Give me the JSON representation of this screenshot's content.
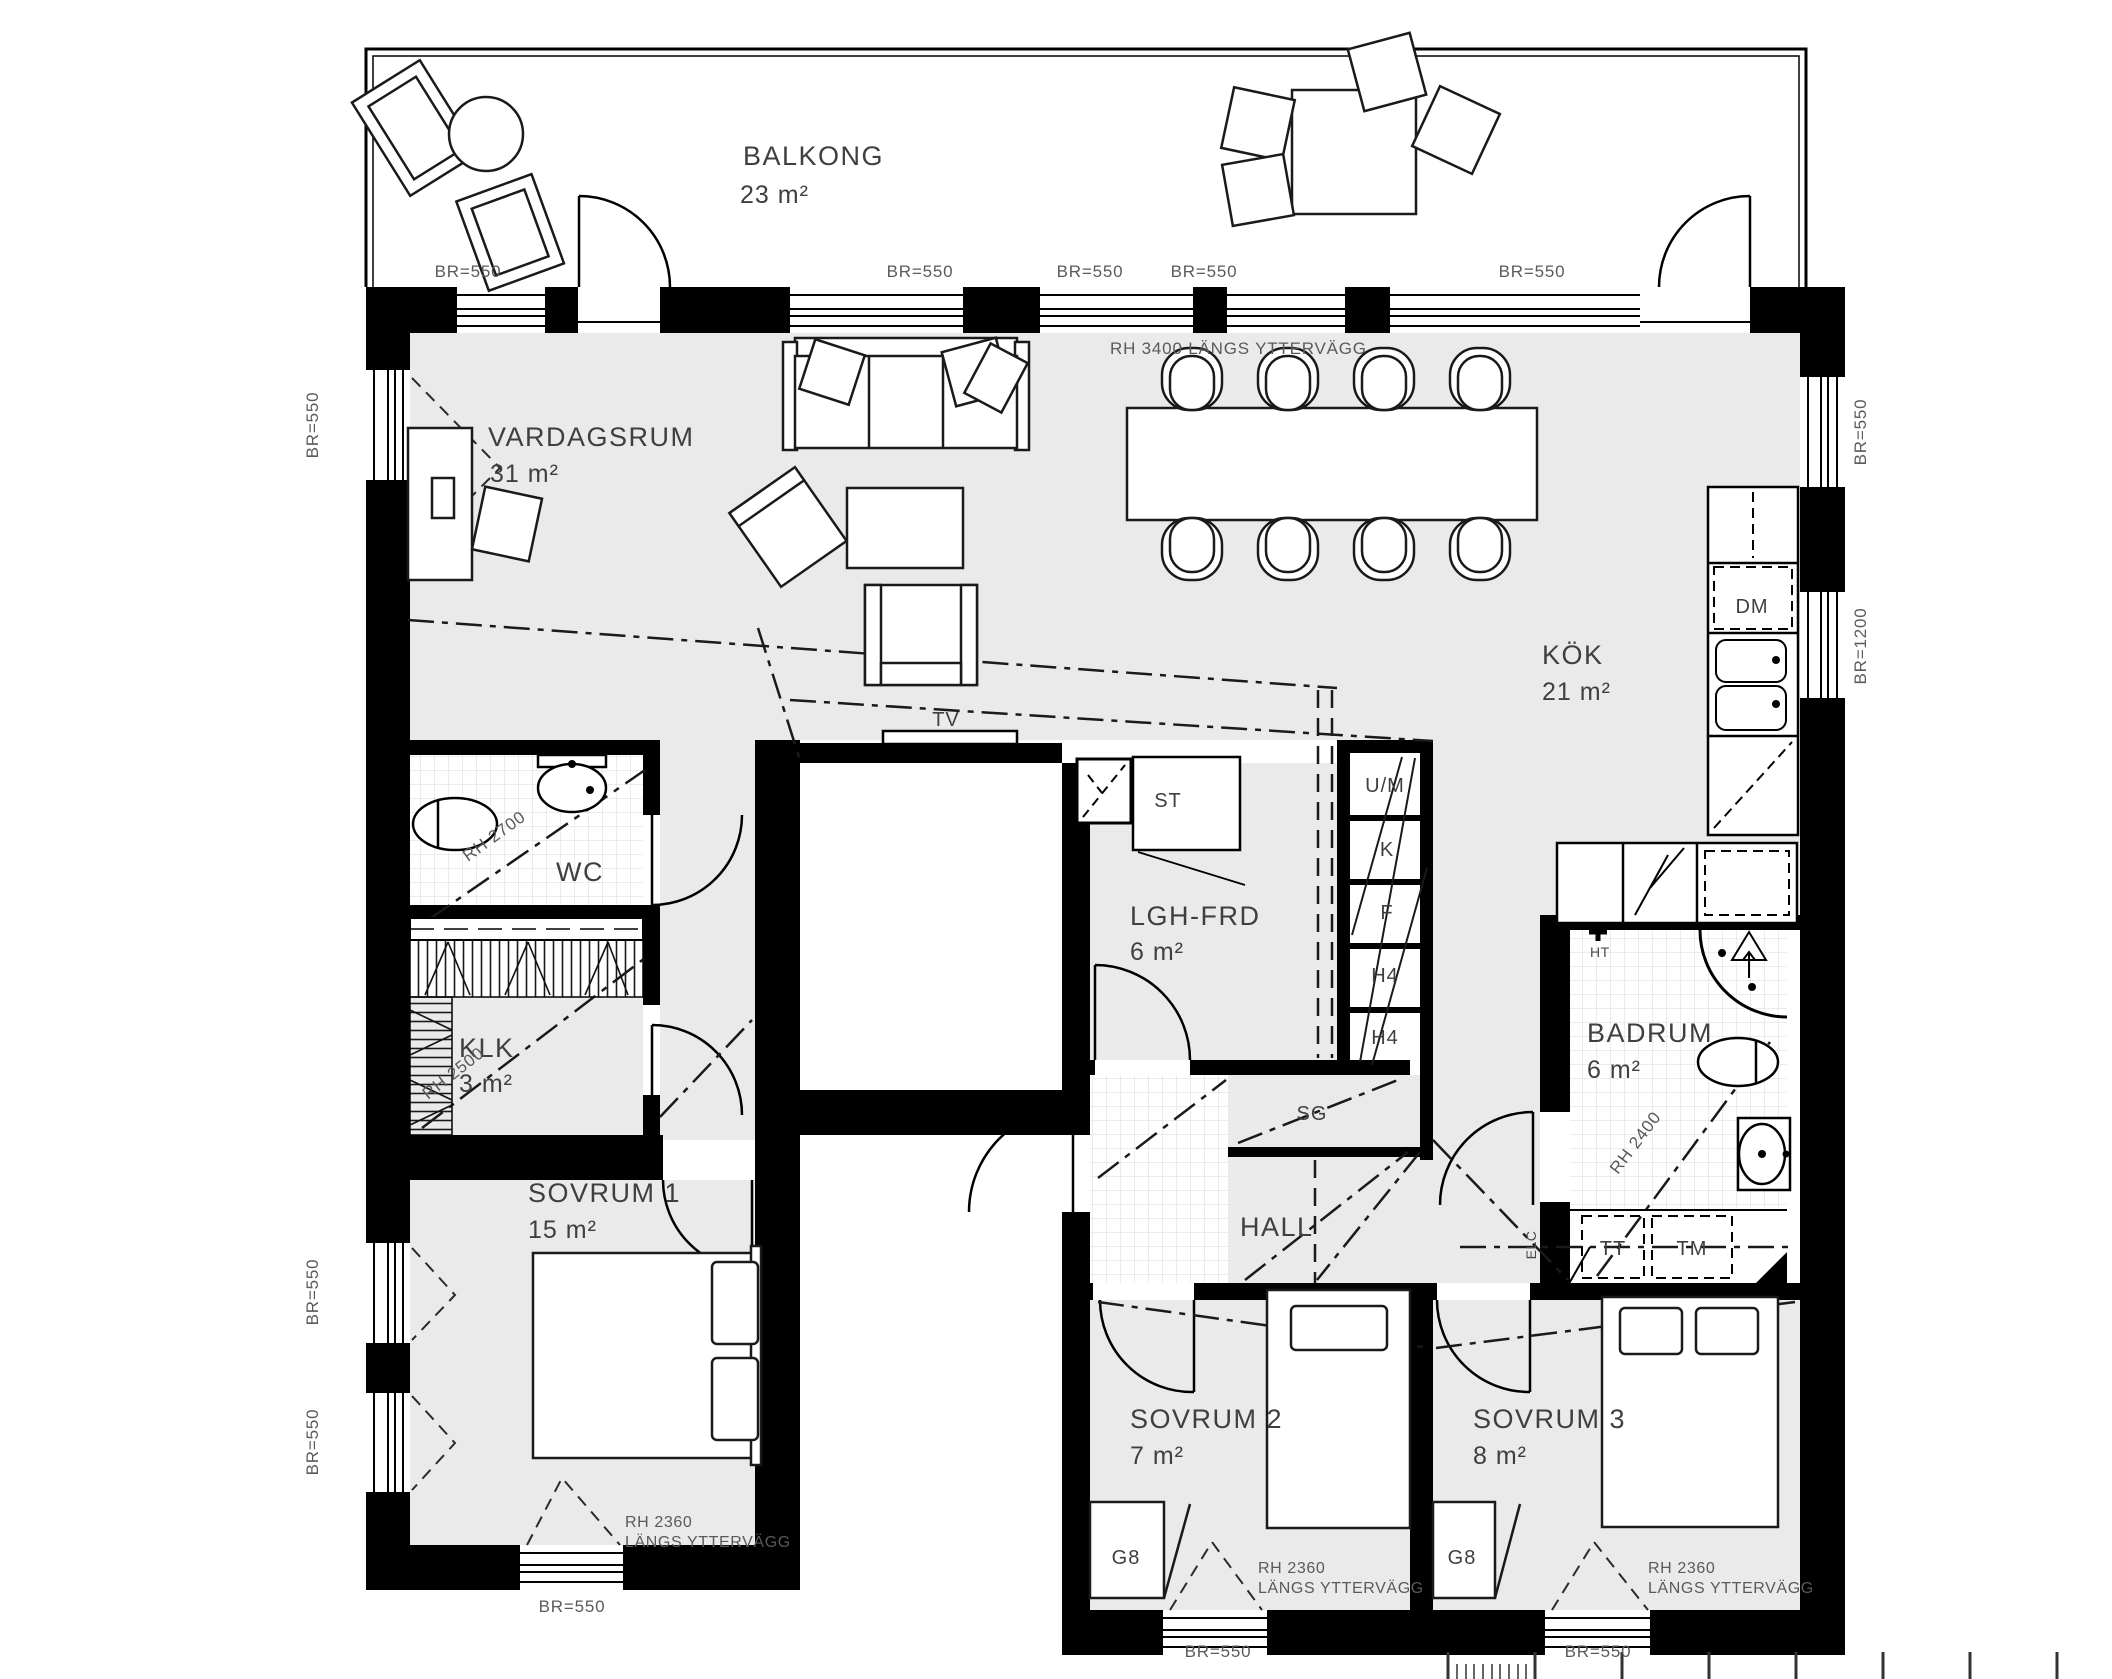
{
  "rooms": {
    "balkong": {
      "name": "BALKONG",
      "area": "23 m²"
    },
    "vardagsrum": {
      "name": "VARDAGSRUM",
      "area": "31 m²"
    },
    "kok": {
      "name": "KÖK",
      "area": "21 m²"
    },
    "wc": {
      "name": "WC"
    },
    "klk": {
      "name": "KLK",
      "area": "3 m²"
    },
    "lgh_frd": {
      "name": "LGH-FRD",
      "area": "6 m²"
    },
    "sovrum1": {
      "name": "SOVRUM 1",
      "area": "15 m²"
    },
    "hall": {
      "name": "HALL"
    },
    "badrum": {
      "name": "BADRUM",
      "area": "6 m²"
    },
    "sovrum2": {
      "name": "SOVRUM 2",
      "area": "7 m²"
    },
    "sovrum3": {
      "name": "SOVRUM 3",
      "area": "8 m²"
    }
  },
  "fixtures": {
    "tv": "TV",
    "st": "ST",
    "sg": "SG",
    "um": "U/M",
    "kyl": "K",
    "frys": "F",
    "h4_upper": "H4",
    "h4_lower": "H4",
    "dm": "DM",
    "tt": "TT",
    "tm": "TM",
    "ht": "HT",
    "elc": "ELC",
    "g8_sovrum2": "G8",
    "g8_sovrum3": "G8"
  },
  "annotations": {
    "rh3400": "RH 3400 LÄNGS YTTERVÄGG",
    "rh2700": "RH 2700",
    "rh2500": "RH 2500",
    "rh2400": "RH 2400",
    "rh2360": "RH 2360",
    "langs_yttervagg": "LÄNGS YTTERVÄGG",
    "br550": "BR=550",
    "br1200": "BR=1200"
  },
  "colors": {
    "wall": "#000000",
    "floor": "#eaeaea",
    "tile_line": "#d8d8d8",
    "label": "#3f3f3f",
    "annotation": "#5a5a5a"
  }
}
